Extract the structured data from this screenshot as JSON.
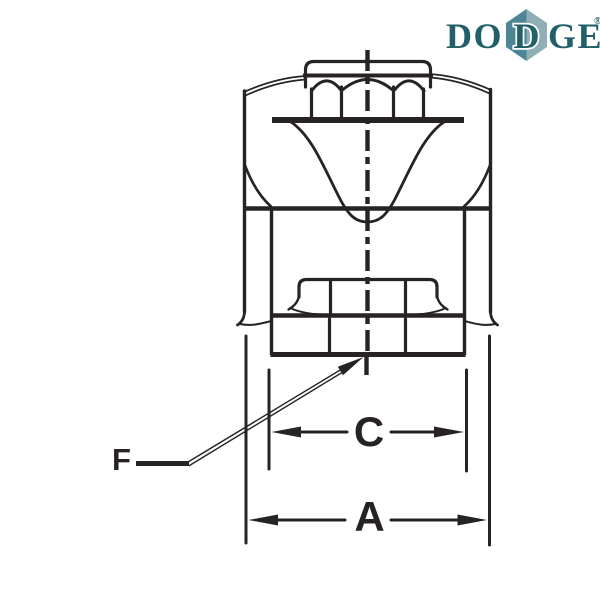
{
  "logo": {
    "brand_pre": "DO",
    "brand_mid": "D",
    "brand_post": "GE",
    "registered_mark": "®",
    "text_color": "#215f69",
    "diamond_left_color": "#4c8593",
    "diamond_right_color": "#90aeb5"
  },
  "diagram": {
    "line_color": "#272324",
    "dimension_labels": {
      "dim_a": "A",
      "dim_c": "C",
      "dim_f": "F"
    }
  }
}
